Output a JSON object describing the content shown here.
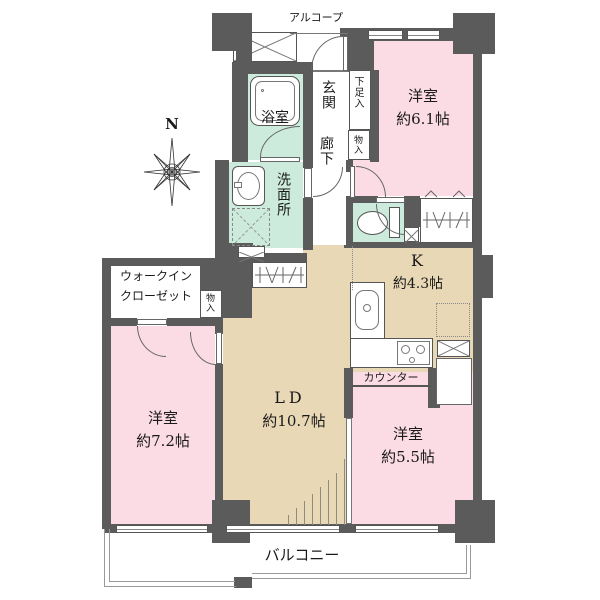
{
  "plan": {
    "compass_north": "N",
    "alcove": "アルコープ",
    "balcony": "バルコニー",
    "counter": "カウンター",
    "rooms": {
      "western1": {
        "name": "洋室",
        "size": "約6.1帖"
      },
      "western2": {
        "name": "洋室",
        "size": "約7.2帖"
      },
      "western3": {
        "name": "洋室",
        "size": "約5.5帖"
      },
      "kitchen": {
        "name": "K",
        "size": "約4.3帖"
      },
      "living_dining": {
        "name": "LD",
        "size": "約10.7帖"
      },
      "bathroom": {
        "name": "浴室"
      },
      "washroom": {
        "name": "洗面所"
      },
      "entrance": {
        "name": "玄関"
      },
      "corridor": {
        "name": "廊下"
      },
      "shoe_cabinet": {
        "name": "下足入"
      },
      "hall_storage": {
        "name": "物入"
      },
      "wic_storage": {
        "name": "物入"
      },
      "walk_in_closet": {
        "line1": "ウォークイン",
        "line2": "クローゼット"
      }
    },
    "colors": {
      "wall": "#5b5b5b",
      "room_pink": "#fbdce4",
      "room_beige": "#e8d8b6",
      "room_mint": "#cdebdc",
      "outline": "#777777"
    }
  }
}
